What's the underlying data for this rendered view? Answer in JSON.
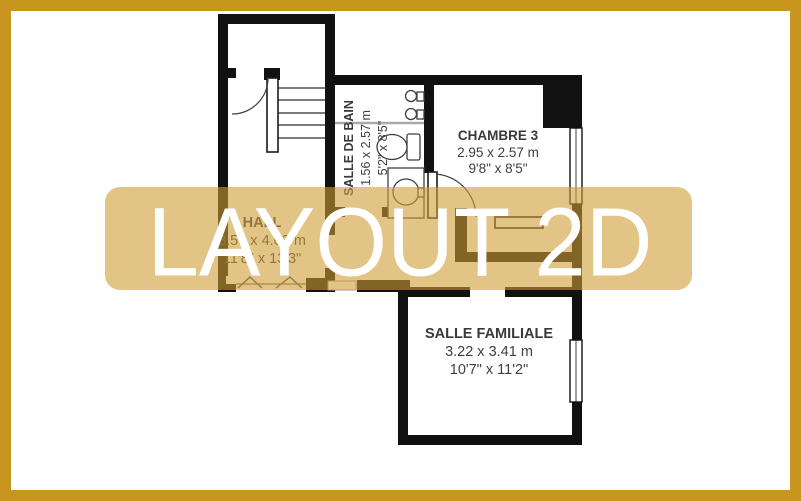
{
  "watermark": {
    "label": "LAYOUT 2D"
  },
  "frame": {
    "border_color": "#C8961E"
  },
  "banner": {
    "fill": "rgba(208,157,55,0.60)",
    "text_color": "#ffffff"
  },
  "colors": {
    "wall": "#111111",
    "fixture_line": "#3f3f3f"
  },
  "rooms": {
    "salle_de_bain": {
      "name": "SALLE DE BAIN",
      "size_metric": "1.56 x 2.57 m",
      "size_imperial": "5'2\" x 8'5\""
    },
    "chambre3": {
      "name": "CHAMBRE 3",
      "size_metric": "2.95 x 2.57 m",
      "size_imperial": "9'8\" x 8'5\""
    },
    "hall": {
      "name": "HALL",
      "size_metric": "3.56 x 4.03 m",
      "size_imperial": "11'8\" x 13'3\""
    },
    "salle_familiale": {
      "name": "SALLE FAMILIALE",
      "size_metric": "3.22 x 3.41 m",
      "size_imperial": "10'7\" x 11'2\""
    }
  }
}
